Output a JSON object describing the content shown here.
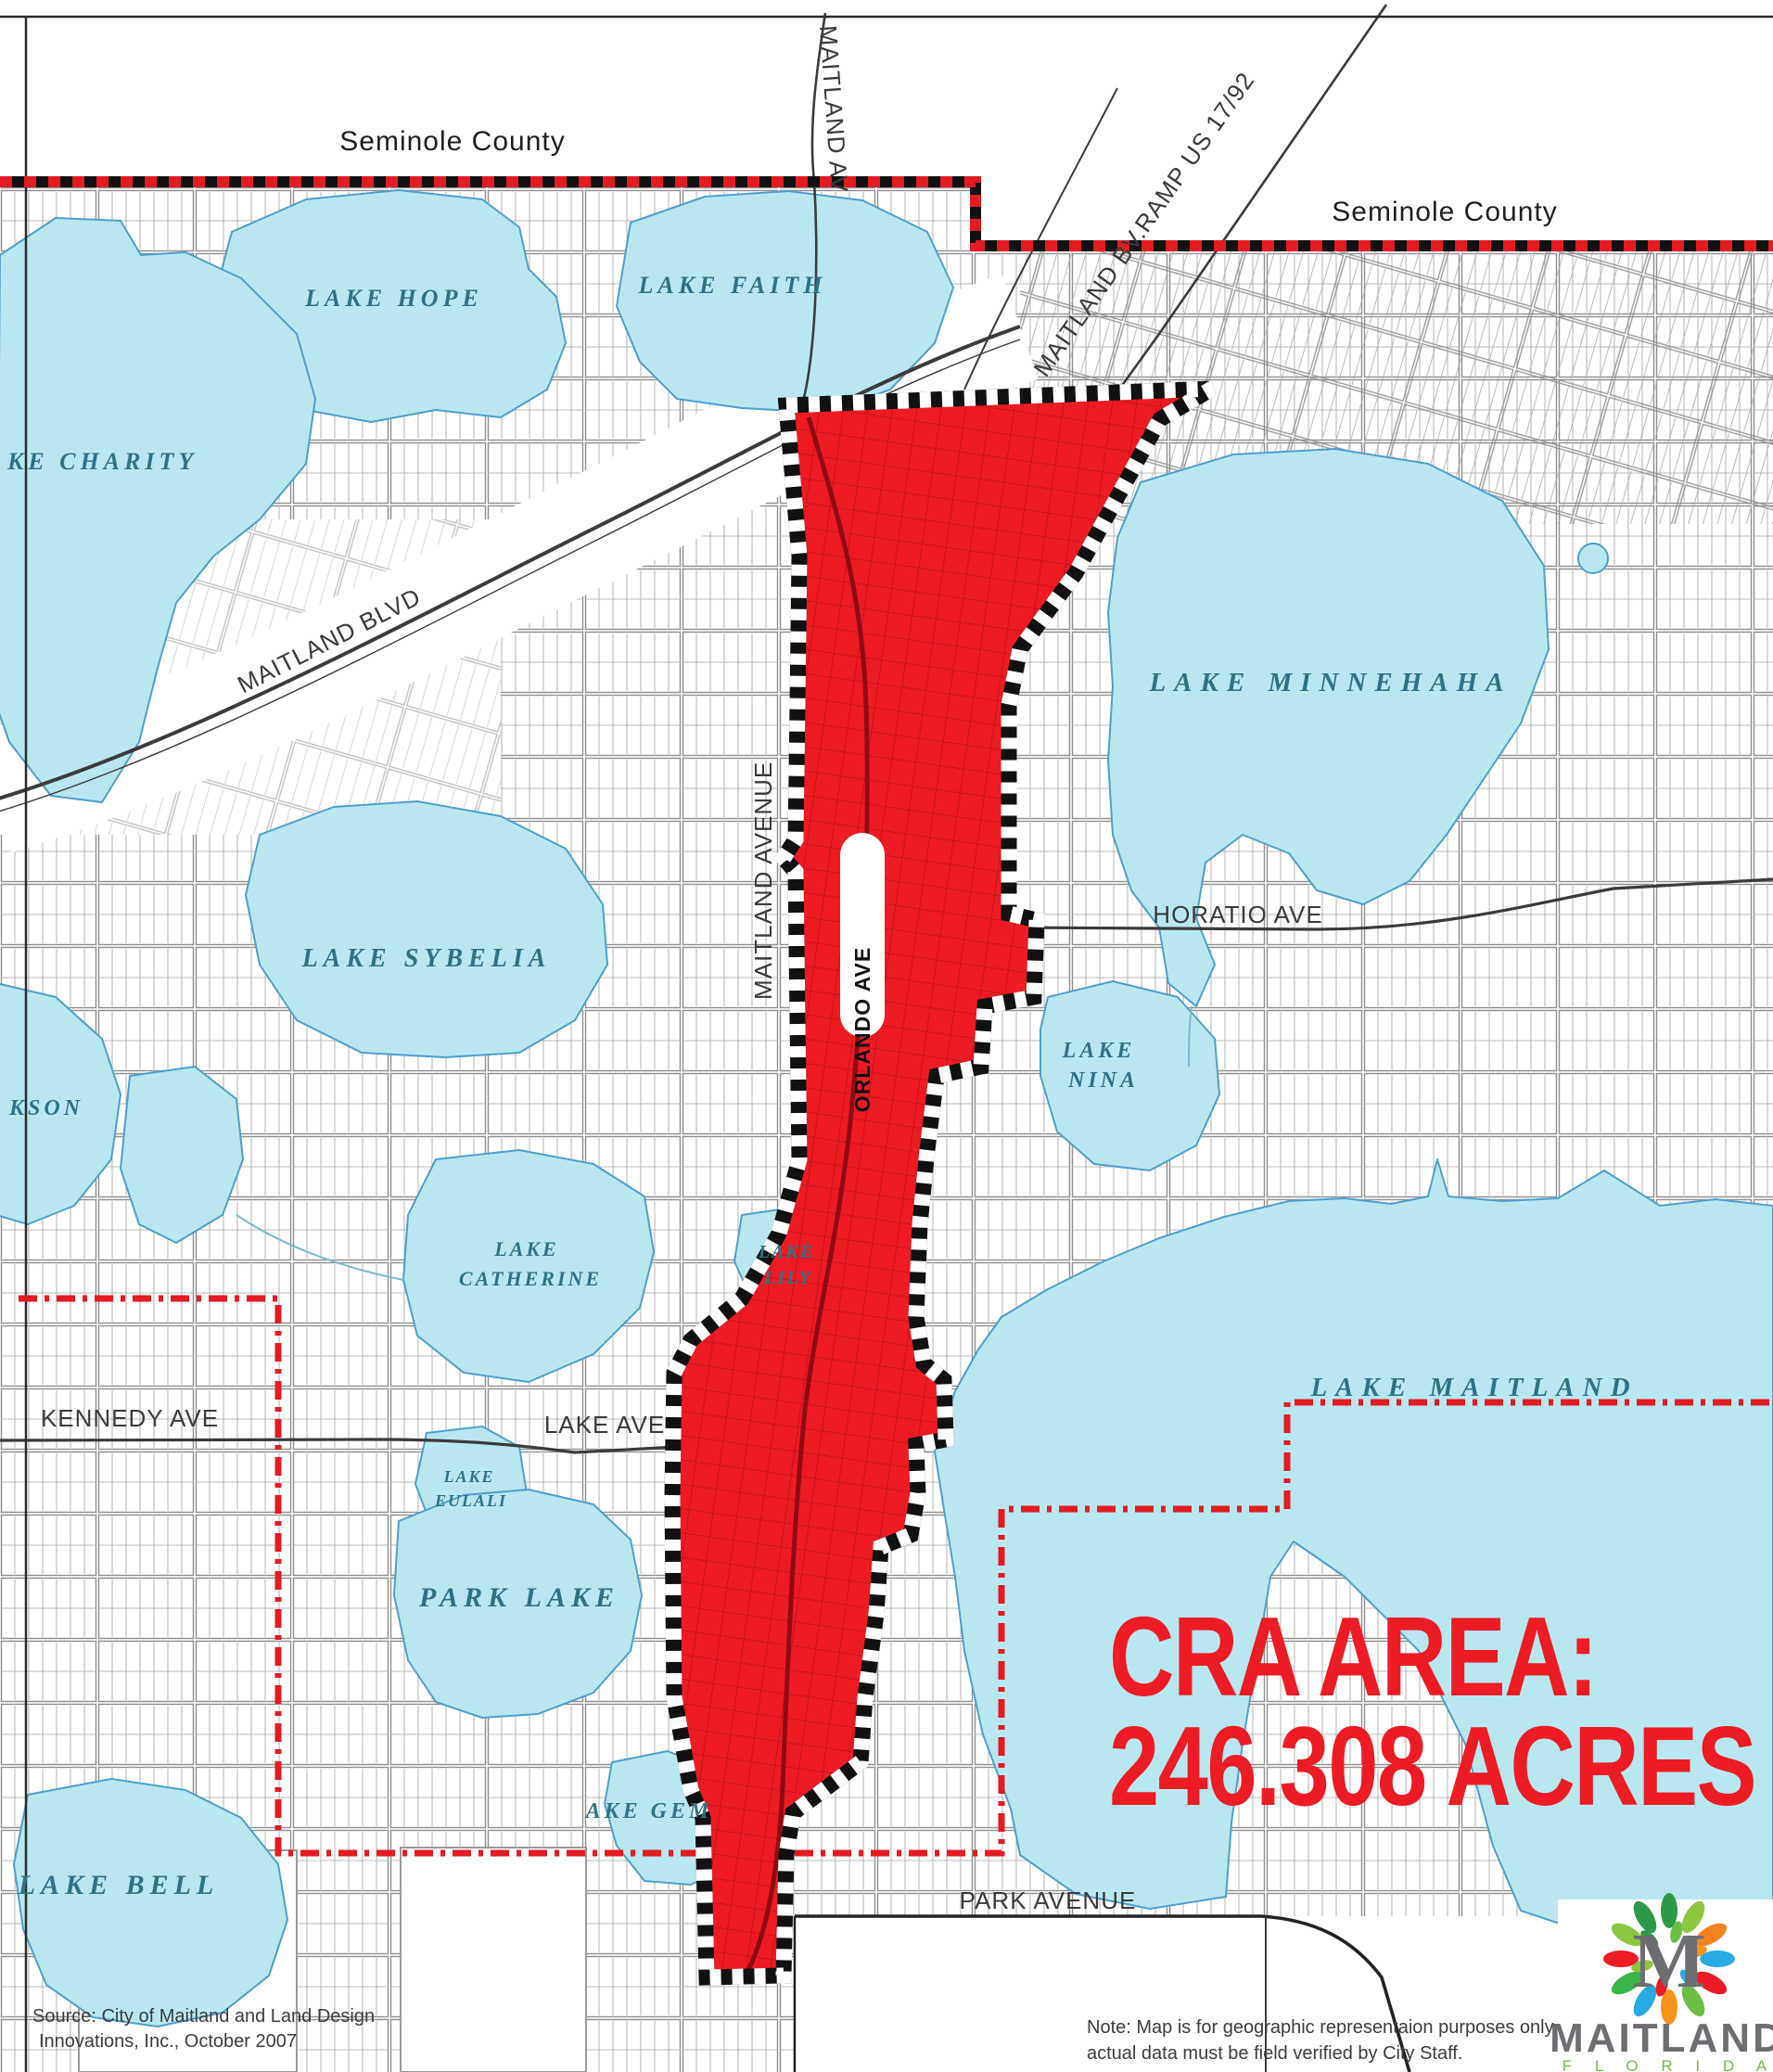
{
  "map": {
    "title_context": "City of Maitland CRA boundary map",
    "region_labels": {
      "seminole_county_1": "Seminole County",
      "seminole_county_2": "Seminole County"
    },
    "road_labels": {
      "maitland_av": "MAITLAND AV",
      "maitland_bv_ramp": "MAITLAND BV.RAMP   US 17/92",
      "maitland_blvd": "MAITLAND BLVD",
      "maitland_avenue": "MAITLAND AVENUE",
      "orlando_ave": "ORLANDO AVE",
      "horatio_ave": "HORATIO AVE",
      "kennedy_ave": "KENNEDY AVE",
      "lake_ave": "LAKE AVE",
      "park_avenue": "PARK AVENUE"
    },
    "lake_labels": {
      "hope": "LAKE  HOPE",
      "faith": "LAKE  FAITH",
      "charity": "KE  CHARITY",
      "sybelia": "LAKE  SYBELIA",
      "jackson_partial": "KSON",
      "minnehaha": "LAKE  MINNEHAHA",
      "nina_line1": "LAKE",
      "nina_line2": "NINA",
      "lily_line1": "LAKE",
      "lily_line2": "LILY",
      "catherine_line1": "LAKE",
      "catherine_line2": "CATHERINE",
      "eulali_line1": "LAKE",
      "eulali_line2": "EULALI",
      "maitland": "LAKE  MAITLAND",
      "park_lake": "PARK  LAKE",
      "gem_partial": "AKE  GEM",
      "bell": "LAKE  BELL"
    },
    "annotation": {
      "cra_line1": "CRA AREA:",
      "cra_line2": "246.308 ACRES"
    },
    "source_note": {
      "line1": "Source:  City of Maitland and Land Design",
      "line2": "Innovations, Inc., October 2007"
    },
    "disclaimer": {
      "line1": "Note: Map is for geographic representaion purposes only,",
      "line2": "actual data must be field verified by City Staff."
    },
    "colors": {
      "cra_red": "#ee1b23",
      "cra_street_red": "#b20f16",
      "lake_fill": "#b9e7f0",
      "lake_outline": "#4e9fcc",
      "boundary_red": "#e31b22",
      "checker_black": "#111111",
      "lake_label_teal": "#2d7386",
      "street_gray": "#969696",
      "big_text_red": "#ed1c24"
    }
  },
  "logo": {
    "monogram": "M",
    "city": "MAITLAND",
    "state": "F L O R I D A"
  }
}
